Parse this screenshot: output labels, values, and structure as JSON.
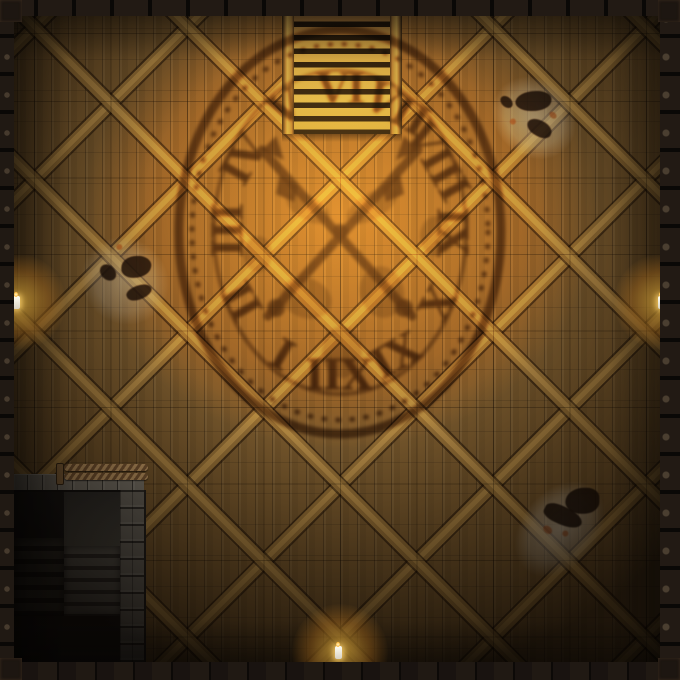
{
  "map": {
    "title": "Clocktower Interior Battle Map",
    "clock": {
      "numerals": [
        "VI",
        "VII",
        "VIII",
        "IX",
        "X",
        "XI",
        "XII",
        "I",
        "II",
        "III",
        "IV",
        "V"
      ],
      "orientation": "rotated-180 (VI at top, XII at bottom)",
      "shadow_color": "#4a2a08"
    },
    "features": {
      "stairs_up": "wooden staircase ascending (top center)",
      "stairs_down": "stone stairwell descending (bottom left)",
      "rope_barrier": "rope barrier at stairwell edge",
      "candle_count": 3,
      "stain_count": 3
    },
    "palette": {
      "wood_base": "#76572c",
      "wood_brace": "#ab8342",
      "glow": "#ffc85a",
      "border_iron": "#171210",
      "stone": "#6a665d",
      "stain_wash": "#c8c0b0"
    },
    "grid": {
      "cell_px": 76.5,
      "line": "rgba(12,6,0,0.35)"
    }
  }
}
